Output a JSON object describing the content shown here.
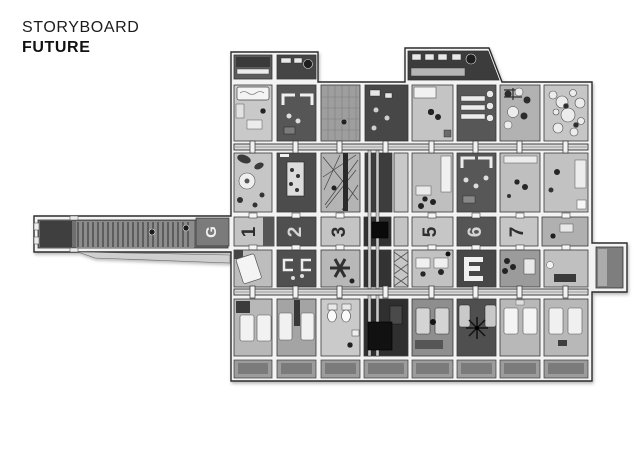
{
  "title": {
    "line1": "STORYBOARD",
    "line2": "FUTURE"
  },
  "corridor": {
    "cells": [
      {
        "label": "G"
      },
      {
        "label": "1"
      },
      {
        "label": "2"
      },
      {
        "label": "3"
      },
      {
        "label": "5"
      },
      {
        "label": "6"
      },
      {
        "label": "7"
      }
    ]
  },
  "palette": {
    "background": "#ffffff",
    "ink": "#1c1c1c",
    "wall_frame": "#f3f3f3",
    "outline": "#2c2c2c",
    "room_dark": "#4c4c4c",
    "room_light": "#c6c6c6",
    "corridor_dark": "#555555",
    "label_on_dark": "#e0e0e0",
    "label_on_light": "#2e2e2e"
  }
}
